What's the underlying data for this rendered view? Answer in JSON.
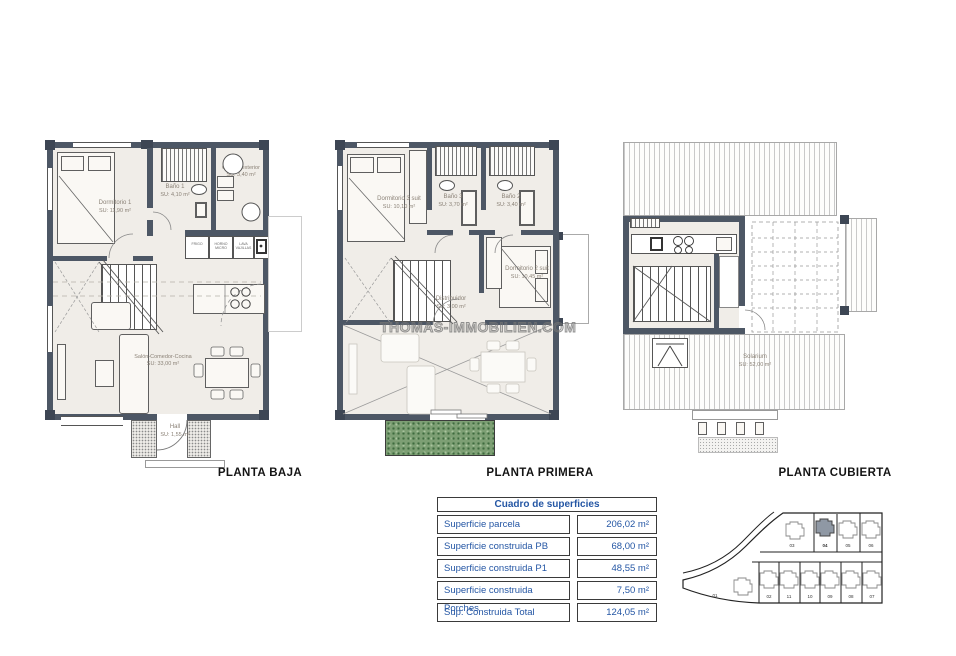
{
  "watermark": {
    "text": "THOMAS-IMMOBILIEN.COM"
  },
  "plans": [
    {
      "id": "planta-baja",
      "title": "PLANTA BAJA",
      "rooms": [
        {
          "name": "Dormitorio 1",
          "area": "SU: 11,90 m²"
        },
        {
          "name": "Baño 1",
          "area": "SU: 4,10 m²"
        },
        {
          "name": "Galería exterior",
          "area": "SU: 3,40 m²"
        },
        {
          "name": "Salón-Comedor-Cocina",
          "area": "SU: 33,00 m²"
        },
        {
          "name": "Hall",
          "area": "SU: 1,55 m²"
        }
      ],
      "appliances": [
        "FRIGO",
        "HORNO MICRO",
        "LAVA VAJILLAS"
      ]
    },
    {
      "id": "planta-primera",
      "title": "PLANTA PRIMERA",
      "rooms": [
        {
          "name": "Dormitorio 3 suit",
          "area": "SU: 10,10 m²"
        },
        {
          "name": "Baño 3",
          "area": "SU: 3,70 m²"
        },
        {
          "name": "Baño 2",
          "area": "SU: 3,40 m²"
        },
        {
          "name": "Dormitorio 2 suit",
          "area": "SU: 10,45 m²"
        },
        {
          "name": "Distribuidor",
          "area": "SU: 3,00 m²"
        }
      ]
    },
    {
      "id": "planta-cubierta",
      "title": "PLANTA CUBIERTA",
      "rooms": [
        {
          "name": "Solarium",
          "area": "SU: 52,00 m²"
        }
      ]
    }
  ],
  "table": {
    "title": "Cuadro de superficies",
    "rows": [
      {
        "label": "Superficie parcela",
        "value": "206,02 m²"
      },
      {
        "label": "Superficie construida PB",
        "value": "68,00 m²"
      },
      {
        "label": "Superficie construida P1",
        "value": "48,55 m²"
      },
      {
        "label": "Superficie construida Porches",
        "value": "7,50 m²"
      },
      {
        "label": "Sup. Construida Total",
        "value": "124,05 m²"
      }
    ],
    "text_color": "#2456a4"
  },
  "site_plan": {
    "highlighted_plot": "04",
    "left_plot": "01",
    "top_row": [
      "03",
      "04",
      "05",
      "06"
    ],
    "bottom_row": [
      "02",
      "11",
      "10",
      "09",
      "08",
      "07"
    ]
  },
  "colors": {
    "wall": "#4d5765",
    "floor": "#f0ede8",
    "planter": "#7d9f74",
    "table_blue": "#2456a4"
  }
}
